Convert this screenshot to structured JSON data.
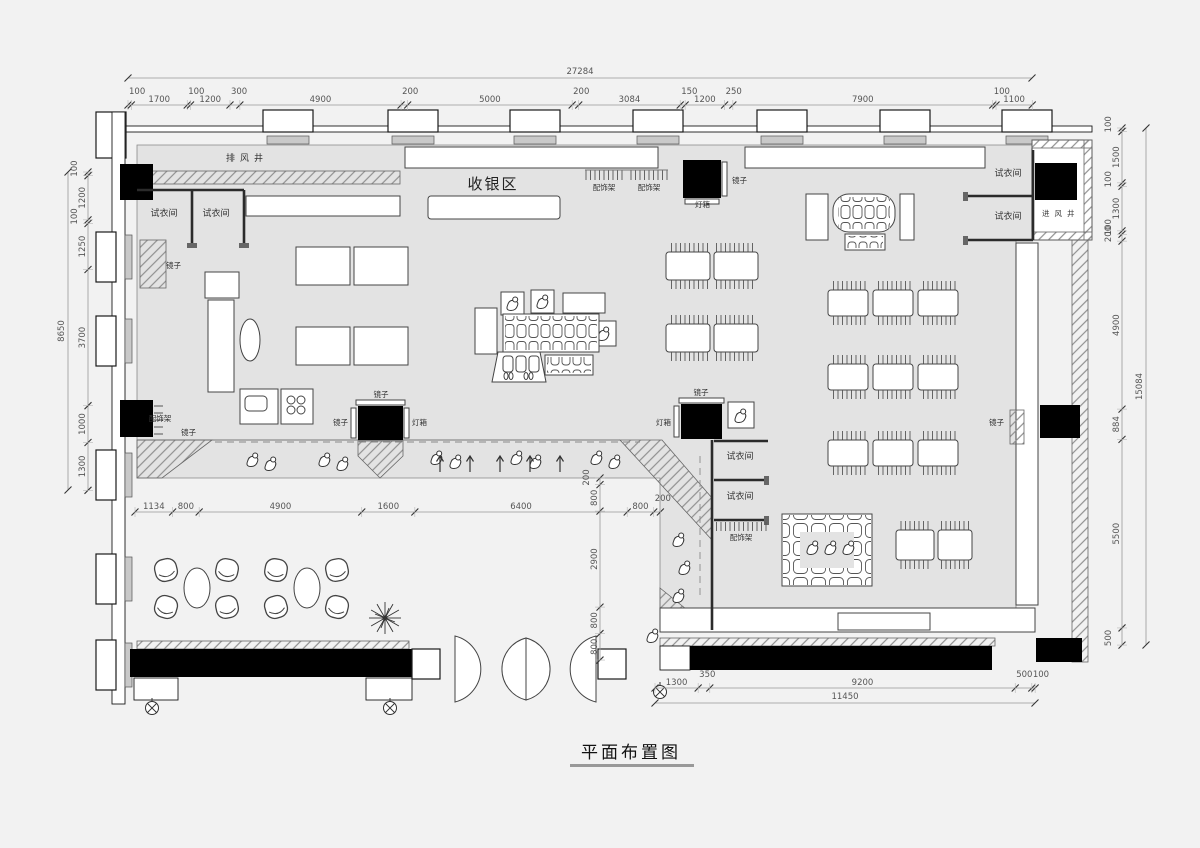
{
  "title": "平面布置图",
  "labels": {
    "exhaust_shaft": "排风井",
    "intake_shaft": "进风井",
    "cashier_area": "收银区",
    "fitting_room": "试衣间",
    "mirror": "镜子",
    "light_box": "灯箱",
    "accessory_rack": "配饰架"
  },
  "dims": {
    "top": {
      "total": "27284",
      "segments": [
        "100",
        "1700",
        "100",
        "1200",
        "300",
        "4900",
        "200",
        "5000",
        "200",
        "3084",
        "150",
        "1200",
        "250",
        "7900",
        "100",
        "1100"
      ]
    },
    "left": {
      "total": "8650",
      "segments": [
        "100",
        "1200",
        "100",
        "1250",
        "3700",
        "1000",
        "1300"
      ]
    },
    "right": {
      "total": "15084",
      "segments": [
        "100",
        "1500",
        "100",
        "1300",
        "100",
        "200",
        "4900",
        "884",
        "5500",
        "500"
      ]
    },
    "bottom_inner": {
      "segments": [
        "1134",
        "800",
        "4900",
        "1600",
        "6400",
        "800",
        "200"
      ]
    },
    "bottom_outer": {
      "total": "11450",
      "segments": [
        "1300",
        "350",
        "9200",
        "500",
        "100"
      ]
    },
    "mid_vertical": {
      "segments": [
        "200",
        "800",
        "2900",
        "800",
        "800"
      ]
    }
  },
  "colors": {
    "floor": "#e3e3e3",
    "wall": "#1a1a1a",
    "background": "#f2f2f2"
  }
}
